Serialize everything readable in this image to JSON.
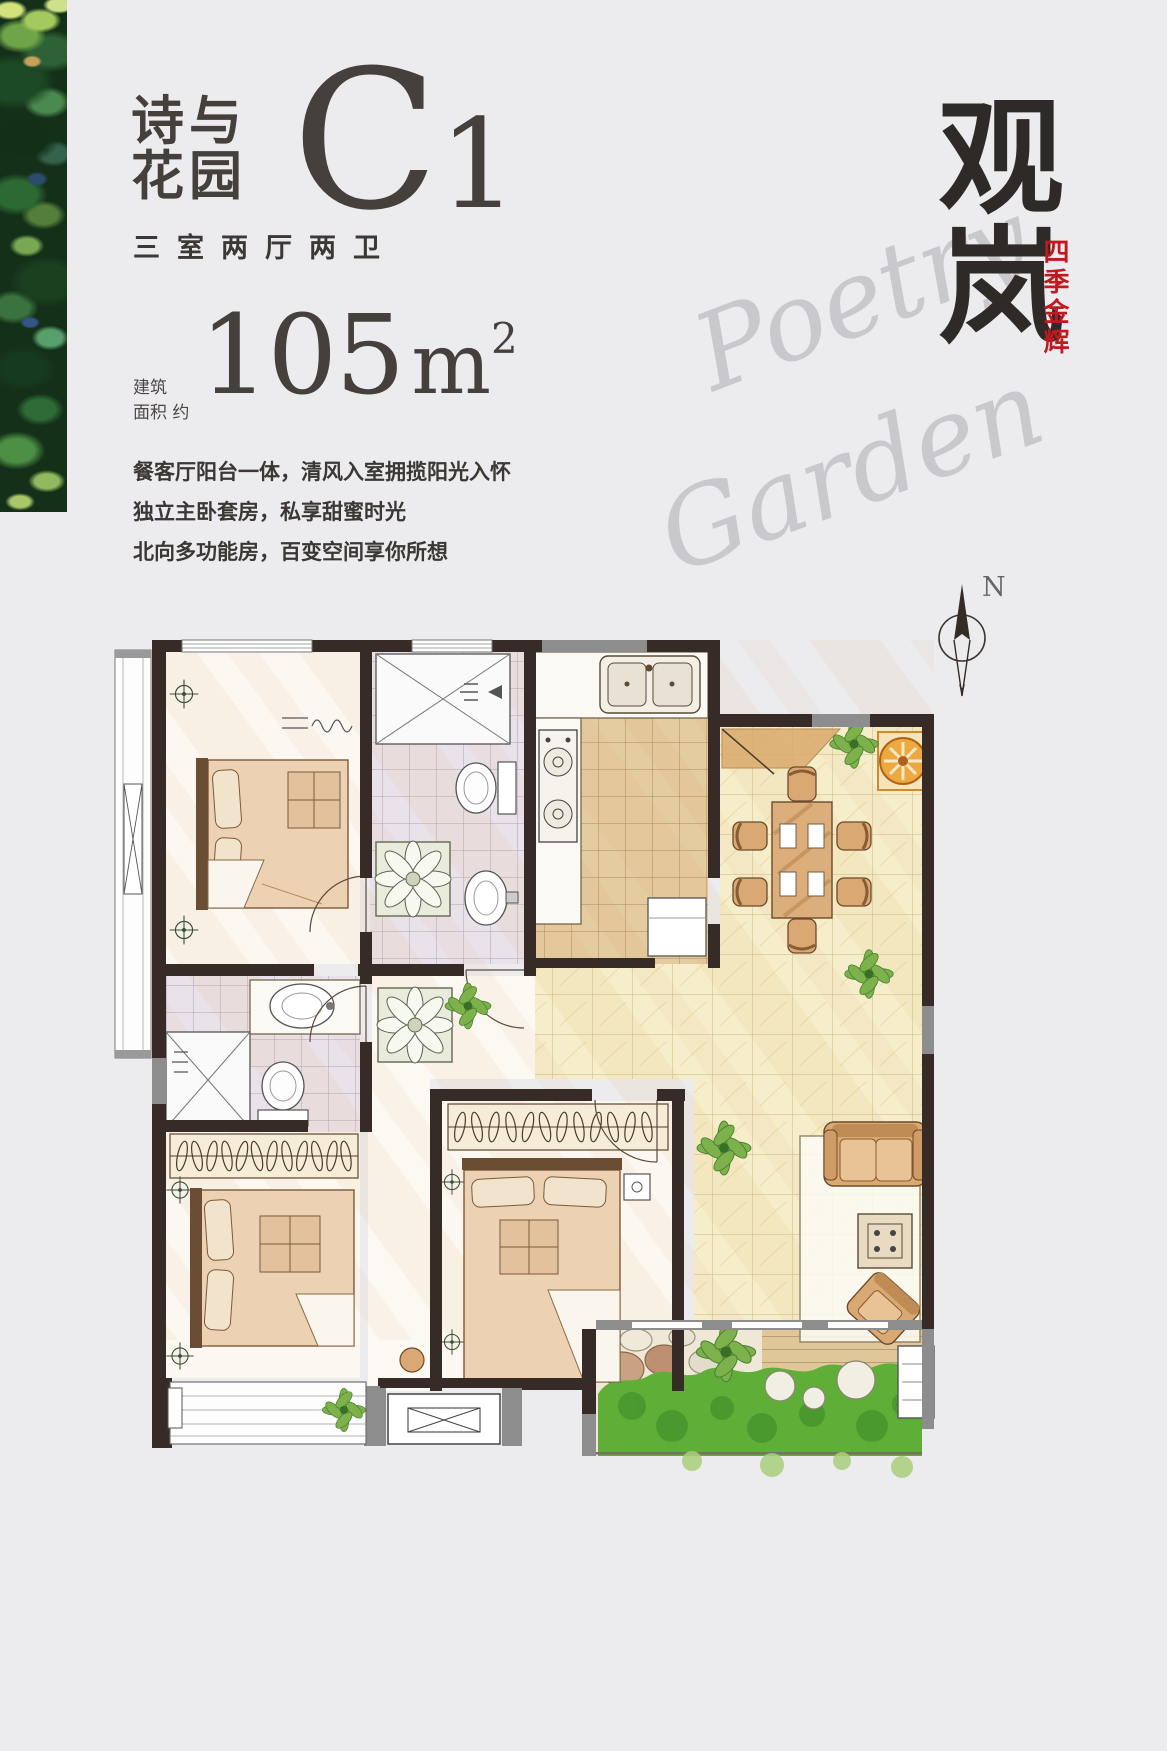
{
  "page": {
    "background": "#ececee"
  },
  "artwork": {
    "name": "impressionist-foliage-strip"
  },
  "header": {
    "title_line1": "诗与",
    "title_line2": "花园",
    "plan_letter": "C",
    "plan_number": "1",
    "spec": "三室两厅两卫"
  },
  "area": {
    "label_top": "建筑",
    "label_bottom": "面积 约",
    "value": "105",
    "unit": "m",
    "unit_exponent": "2"
  },
  "description": {
    "line1": "餐客厅阳台一体，清风入室拥揽阳光入怀",
    "line2": "独立主卧套房，私享甜蜜时光",
    "line3": "北向多功能房，百变空间享你所想"
  },
  "brand": {
    "logo_char_top": "观",
    "logo_char_bottom": "岚",
    "seal_vertical_text": "四季金辉"
  },
  "watermark": {
    "word_top": "Poetry",
    "word_bottom": "Garden"
  },
  "compass": {
    "north_label": "N"
  },
  "palette": {
    "background": "#ececee",
    "ink": "#45403c",
    "seal_red": "#c0191f",
    "script_gray": "#c8c8cd",
    "wall_dark": "#362b26",
    "wall_gray": "#8d8d8d",
    "tile_yellow": "#f6eeca",
    "tile_brown": "#e5cba0",
    "tile_lavender": "#eae2ea",
    "furniture_tan": "#dcae7c",
    "plant_green": "#7db14c",
    "grass_green": "#5fae38",
    "orange_accent": "#eba93f"
  }
}
